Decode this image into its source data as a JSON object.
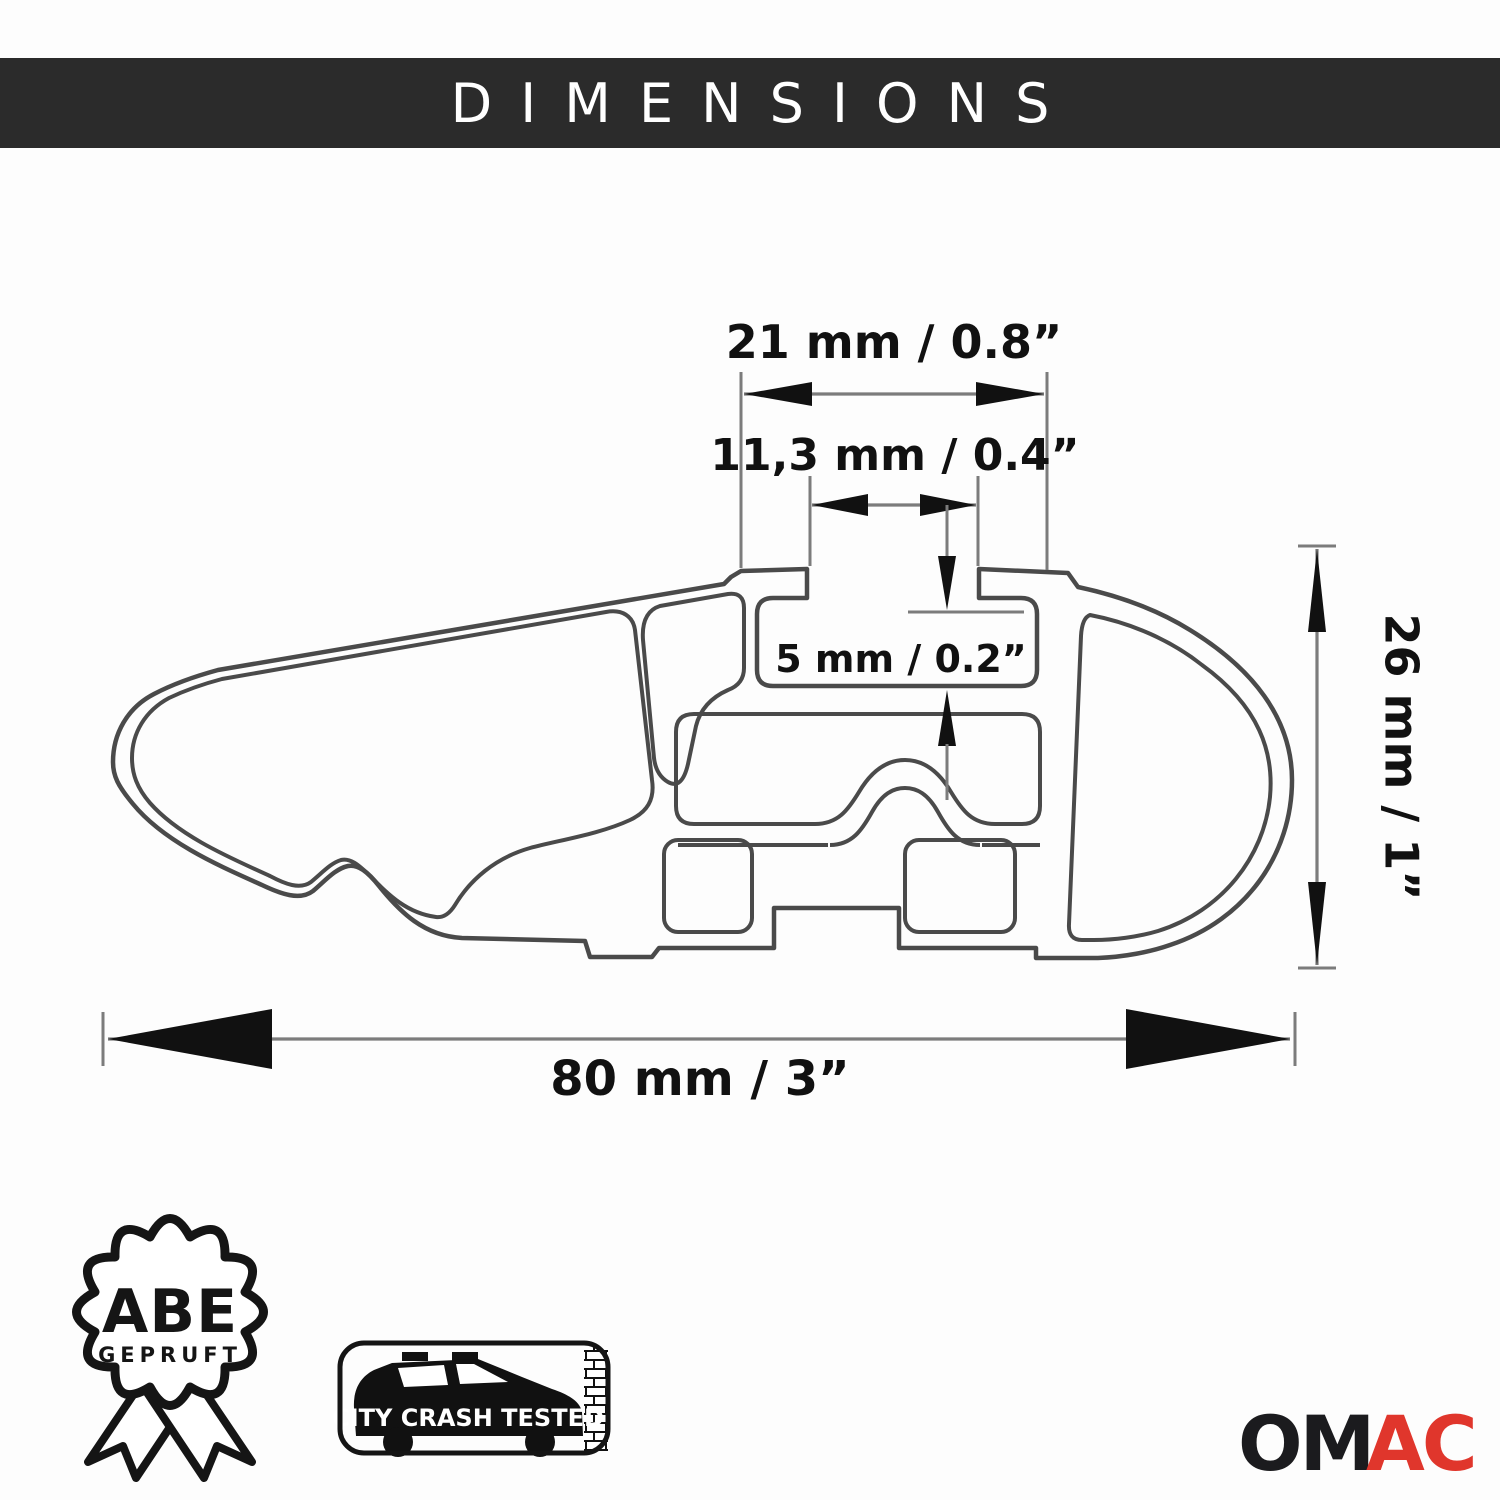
{
  "header": {
    "title": "DIMENSIONS"
  },
  "colors": {
    "header_bg": "#2b2b2b",
    "header_text": "#ffffff",
    "line": "#4a4a4a",
    "dim_line": "#7c7c7c",
    "arrow": "#111111",
    "text": "#111111",
    "logo_om": "#1b1b1e",
    "logo_ac": "#e0362c"
  },
  "dimensions": {
    "top_width": "21 mm / 0.8”",
    "slot_width": "11,3 mm / 0.4”",
    "slot_depth": "5 mm / 0.2”",
    "height": "26 mm / 1”",
    "overall_width": "80 mm / 3”"
  },
  "badges": {
    "abe": {
      "title": "ABE",
      "subtitle": "GEPRUFT"
    },
    "crash_test": {
      "label": "CITY CRASH TESTED"
    }
  },
  "logo": {
    "part1": "OM",
    "part2": "AC"
  }
}
